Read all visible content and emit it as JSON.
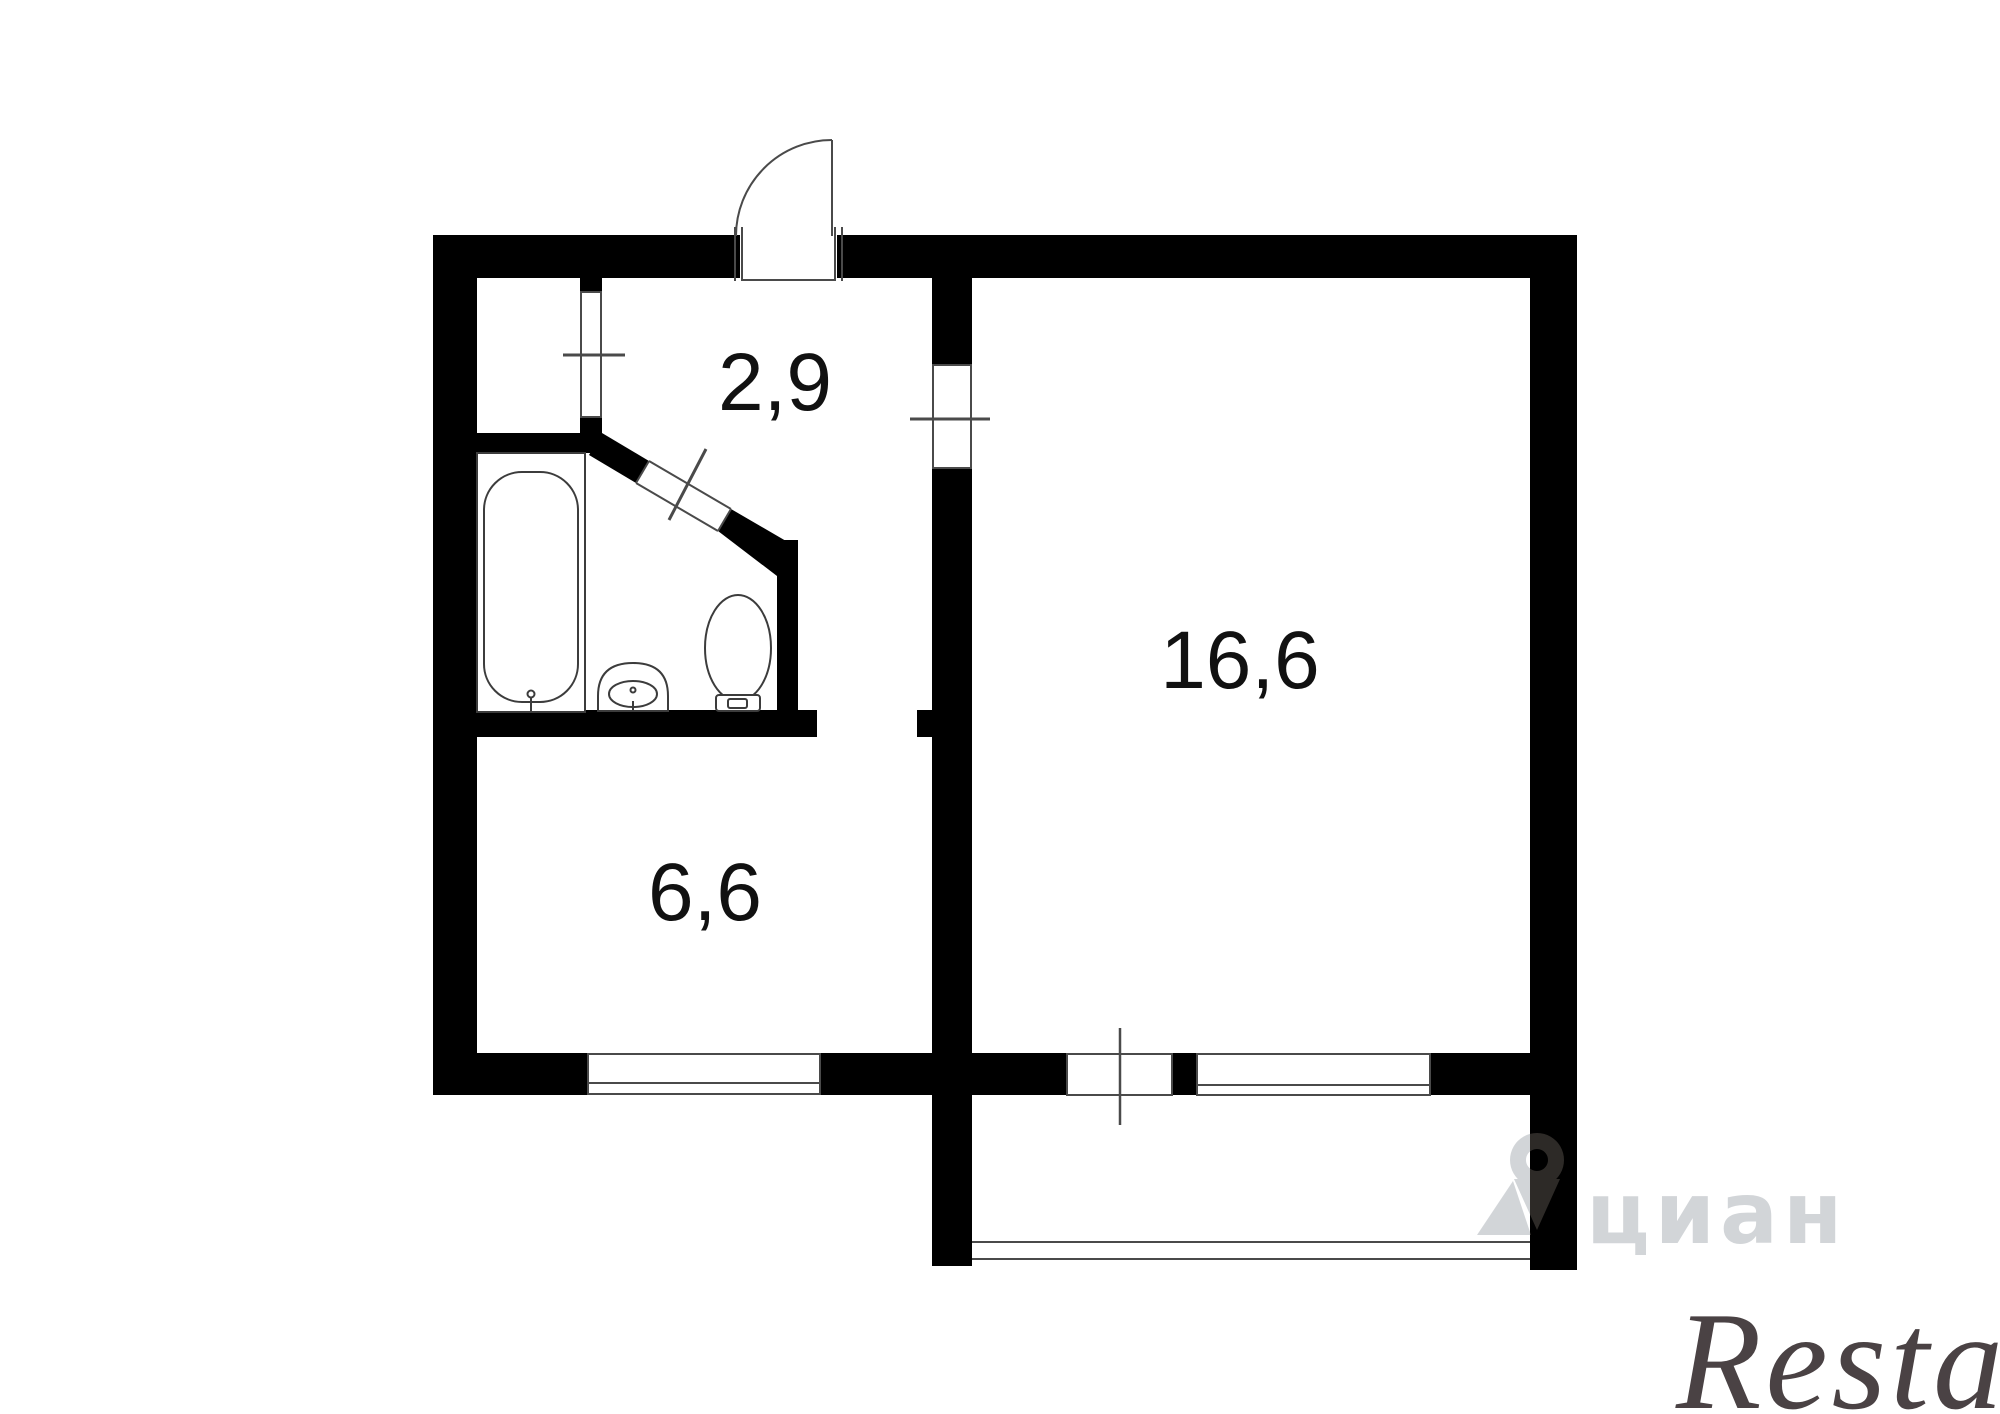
{
  "plan": {
    "type_label": "apartment-floor-plan",
    "rooms": [
      {
        "id": "hallway",
        "label": "2,9"
      },
      {
        "id": "living-room",
        "label": "16,6"
      },
      {
        "id": "kitchen",
        "label": "6,6"
      }
    ]
  },
  "watermarks": {
    "cian": "циан",
    "restate": "Restate"
  },
  "colors": {
    "background": "#ffffff",
    "walls": "#000000",
    "thin_lines": "#4a4a4a",
    "fixtures": "#3c3c3c",
    "label_text": "#111111",
    "cian_watermark_blend": "#2d2a27",
    "restate_watermark": "#4a4244"
  }
}
